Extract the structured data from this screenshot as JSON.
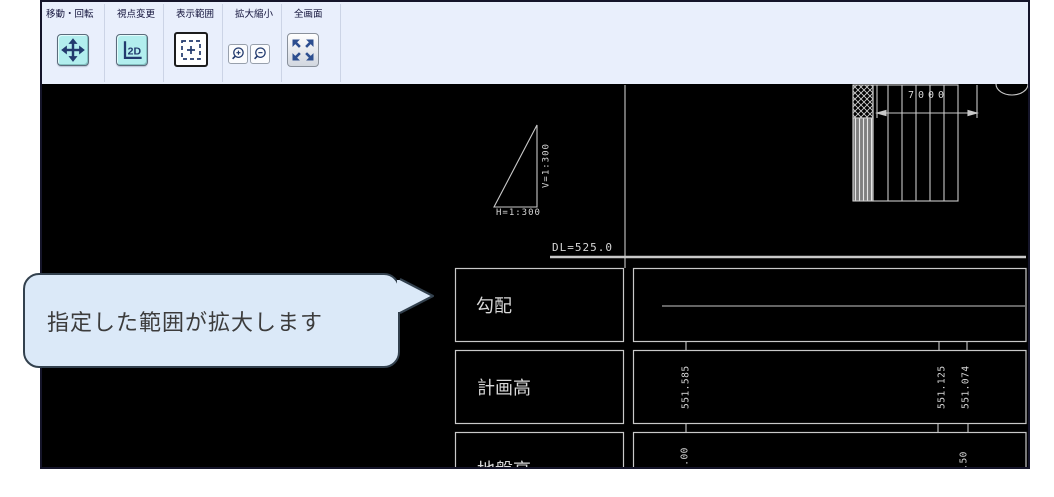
{
  "toolbar": {
    "background": "#e9effc",
    "groups": [
      {
        "label": "移動・回転",
        "buttons": [
          {
            "name": "move-rotate",
            "icon": "move-arrows-icon"
          }
        ]
      },
      {
        "label": "視点変更",
        "buttons": [
          {
            "name": "view-2d",
            "icon": "axis-2d-icon",
            "text": "2D"
          }
        ]
      },
      {
        "label": "表示範囲",
        "buttons": [
          {
            "name": "display-range",
            "icon": "range-select-icon",
            "active": true
          }
        ]
      },
      {
        "label": "拡大縮小",
        "buttons": [
          {
            "name": "zoom-in",
            "icon": "magnifier-plus-icon"
          },
          {
            "name": "zoom-out",
            "icon": "magnifier-minus-icon"
          }
        ]
      },
      {
        "label": "全画面",
        "buttons": [
          {
            "name": "fullscreen",
            "icon": "expand-arrows-icon"
          }
        ]
      }
    ]
  },
  "tooltip": {
    "text": "指定した範囲が拡大します"
  },
  "canvas": {
    "scale_triangle": {
      "h_label": "H=1:300",
      "v_label": "V=1:300"
    },
    "datum_label": "DL=525.0",
    "dimension_label": "7000",
    "profile_table": {
      "rows": [
        {
          "label": "勾配",
          "values": []
        },
        {
          "label": "計画高",
          "values": [
            "551.585",
            "551.125",
            "551.074"
          ]
        },
        {
          "label": "地盤高",
          "values": [
            "2.00",
            "1.50"
          ]
        }
      ]
    }
  },
  "colors": {
    "accent_cyan": "#b2eeee",
    "toolbar_bg": "#e9effc",
    "bubble_bg": "#dbe9f8",
    "cad_line": "#c9c9c9",
    "icon_navy": "#223a6e",
    "canvas_bg": "#000000"
  }
}
